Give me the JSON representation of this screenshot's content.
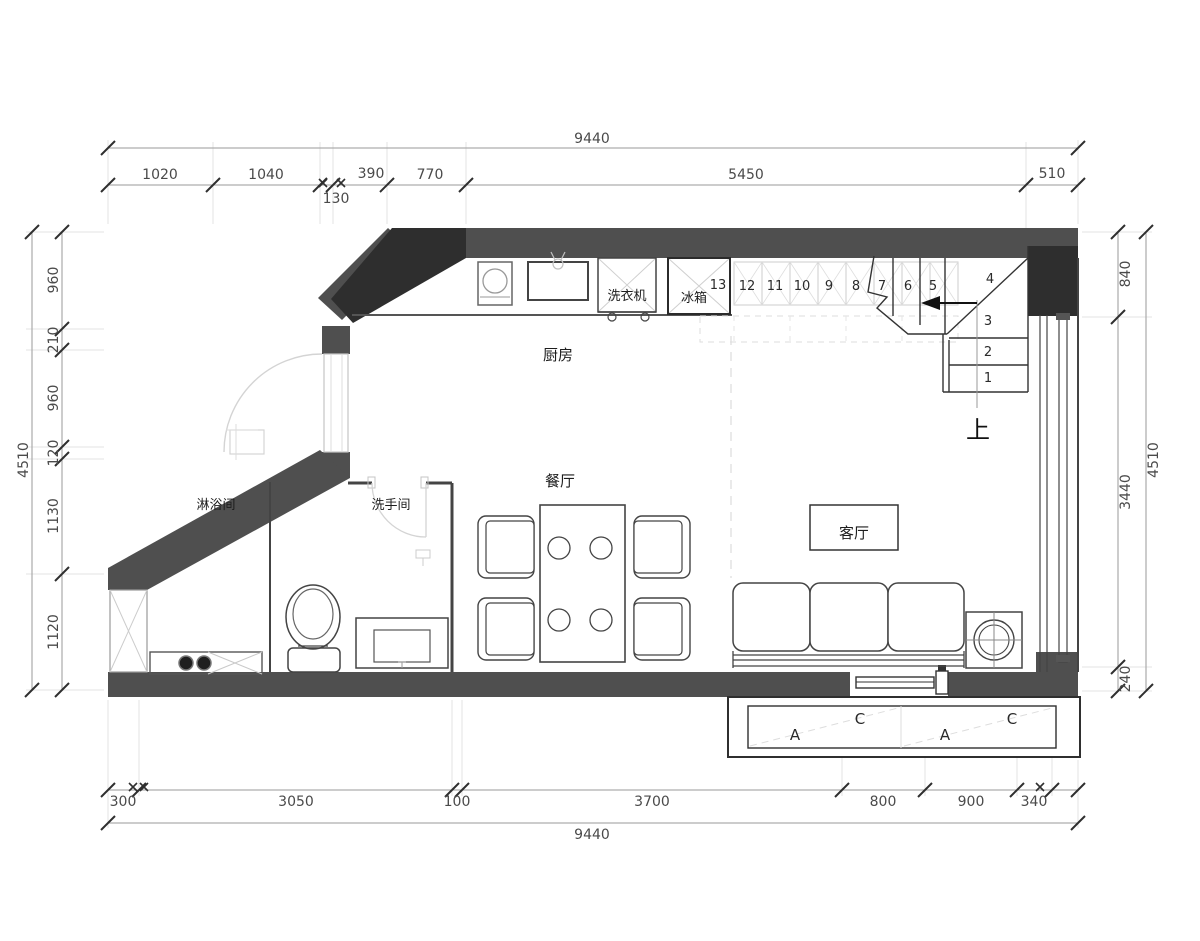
{
  "plan": {
    "rooms": {
      "kitchen": "厨房",
      "dining": "餐厅",
      "living": "客厅",
      "shower": "淋浴间",
      "washroom": "洗手间"
    },
    "labels": {
      "washer": "洗衣机",
      "fridge": "冰箱",
      "up": "上"
    },
    "stair_steps": {
      "s13": "13",
      "s12": "12",
      "s11": "11",
      "s10": "10",
      "s9": "9",
      "s8": "8",
      "s7": "7",
      "s6": "6",
      "s5": "5",
      "s4": "4",
      "s3": "3",
      "s2": "2",
      "s1": "1"
    },
    "window_marks": {
      "a1": "A",
      "c1": "C",
      "a2": "A",
      "c2": "C"
    }
  },
  "dimensions": {
    "top": {
      "total": "9440",
      "seg1": "1020",
      "seg2": "1040",
      "seg3": "130",
      "seg4": "390",
      "seg5": "770",
      "seg6": "5450",
      "seg7": "510"
    },
    "left": {
      "total": "4510",
      "seg1": "960",
      "seg2": "210",
      "seg3": "960",
      "seg4": "120",
      "seg5": "1130",
      "seg6": "1120"
    },
    "right": {
      "total": "4510",
      "seg1": "840",
      "seg2": "3440",
      "seg3": "240"
    },
    "bottom": {
      "total": "9440",
      "seg1": "300",
      "seg2": "3050",
      "seg3": "100",
      "seg4": "3700",
      "seg5": "800",
      "seg6": "900",
      "seg7": "340"
    }
  },
  "colors": {
    "wall": "#4f4f4f",
    "wall_dark": "#2e2e2e",
    "line": "#3c3c3c",
    "light": "#c9c9c9",
    "dim_text": "#4a4a4a"
  }
}
